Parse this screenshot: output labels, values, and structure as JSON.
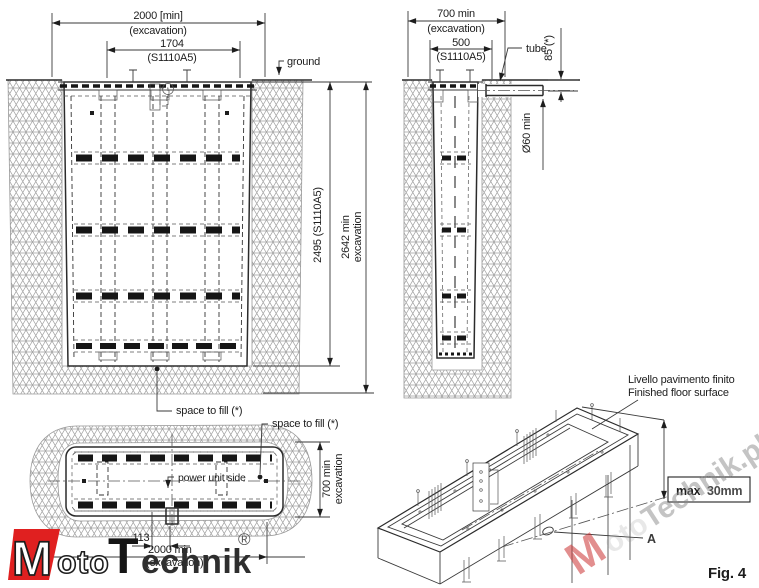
{
  "figure_label": "Fig. 4",
  "front_view": {
    "excavation_width": "2000 [min]",
    "excavation_width_sub": "(excavation)",
    "unit_width": "1704",
    "unit_width_sub": "(S1110A5)",
    "ground_label": "ground",
    "unit_height": "2495 (S1110A5)",
    "excavation_depth_line1": "2642 min",
    "excavation_depth_line2": "excavation",
    "space_to_fill": "space to fill (*)"
  },
  "side_view": {
    "excavation_width": "700 min",
    "excavation_width_sub": "(excavation)",
    "unit_width": "500",
    "unit_width_sub": "(S1110A5)",
    "tube_label": "tube",
    "tube_depth": "85 (*)",
    "tube_diameter": "Ø60 min"
  },
  "plan_view": {
    "space_to_fill": "space to fill (*)",
    "power_unit_label": "power unit side",
    "excavation_width_line1": "700 min",
    "excavation_width_line2": "excavation",
    "offset_dim": "113",
    "excavation_length": "2000 min",
    "excavation_length_sub": "(excavation)"
  },
  "iso_view": {
    "floor_label_it": "Livello pavimento finito",
    "floor_label_en": "Finished floor surface",
    "max_label": "max",
    "max_value": "30mm",
    "detail_label": "A"
  },
  "branding": {
    "logo_m": "M",
    "logo_oto": "oto",
    "logo_t": "T",
    "logo_echnik": "echnik",
    "logo_reg": "®",
    "watermark_m": "M",
    "watermark_oto": "oto",
    "watermark_rest": "Technik.pl"
  },
  "colors": {
    "logo_red": "#e02020",
    "line": "#2b2b2b",
    "hatch_gray": "#9a9a9a",
    "watermark_gray": "#8a8a8a"
  }
}
